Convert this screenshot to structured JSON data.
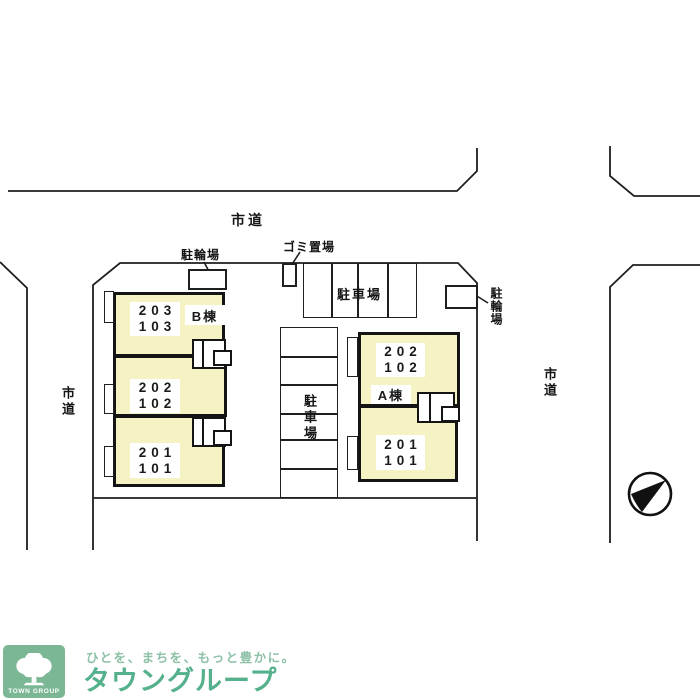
{
  "colors": {
    "building_fill": "#f5f2c3",
    "line": "#1f1f1f",
    "logo_square_green": "#7cb795",
    "brand_green": "#55b18c",
    "tagline_green": "#8cc1a6"
  },
  "roads": {
    "top_label": "市道",
    "left_label": "市道",
    "right_label": "市道"
  },
  "site": {
    "bike_top_label": "駐輪場",
    "bike_right_label": "駐輪場",
    "garbage_label": "ゴミ置場",
    "parking_top_label": "駐車場",
    "parking_center_label": "駐車場"
  },
  "buildings": {
    "b": {
      "label": "B棟",
      "units": [
        {
          "upper": "203",
          "lower": "103"
        },
        {
          "upper": "202",
          "lower": "102"
        },
        {
          "upper": "201",
          "lower": "101"
        }
      ]
    },
    "a": {
      "label": "A棟",
      "units": [
        {
          "upper": "202",
          "lower": "102"
        },
        {
          "upper": "201",
          "lower": "101"
        }
      ]
    }
  },
  "icons": {
    "compass": "north-arrow",
    "logo_tree": "tree"
  },
  "logo": {
    "box_text": "TOWN GROUP",
    "tagline": "ひとを、まちを、もっと豊かに。",
    "brand": "タウングループ"
  }
}
